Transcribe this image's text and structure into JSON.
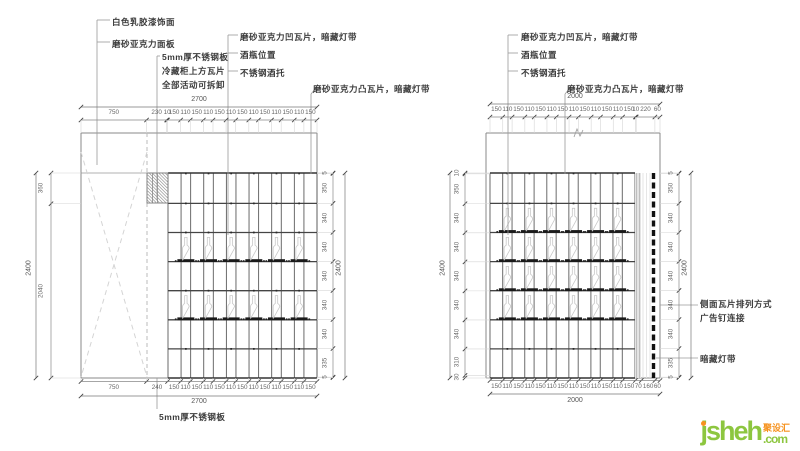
{
  "left_elevation": {
    "callouts": {
      "paint": "白色乳胶漆饰面",
      "panel": "磨砂亚克力面板",
      "steel_line1": "5mm厚不锈钢板",
      "steel_line2": "冷藏柜上方瓦片",
      "steel_line3": "全部活动可拆卸",
      "concave": "磨砂亚克力凹瓦片，暗藏灯带",
      "bottle": "酒瓶位置",
      "holder": "不锈钢酒托",
      "convex": "磨砂亚克力凸瓦片，暗藏灯带",
      "bottom_note": "5mm厚不锈钢板"
    },
    "dims": {
      "top_overall": "2700",
      "bottom_overall": "2700",
      "left_overall": "2400",
      "right_overall": "2400",
      "top": [
        "750",
        "230",
        "10",
        "150",
        "110",
        "150",
        "110",
        "150",
        "110",
        "150",
        "110",
        "150",
        "110",
        "150",
        "110",
        "150"
      ],
      "bottom": [
        "750",
        "240",
        "150",
        "110",
        "150",
        "110",
        "150",
        "110",
        "150",
        "110",
        "150",
        "110",
        "150",
        "110",
        "150"
      ],
      "left": [
        "360",
        "2040"
      ],
      "right": [
        "5",
        "350",
        "340",
        "340",
        "340",
        "340",
        "340",
        "335",
        "5"
      ]
    }
  },
  "right_elevation": {
    "callouts": {
      "concave": "磨砂亚克力凹瓦片，暗藏灯带",
      "bottle": "酒瓶位置",
      "holder": "不锈钢酒托",
      "convex": "磨砂亚克力凸瓦片，暗藏灯带",
      "side_note1": "侧面瓦片排列方式",
      "side_note2": "广告钉连接",
      "light_strip": "暗藏灯带"
    },
    "dims": {
      "top_overall": "2000",
      "bottom_overall": "2000",
      "left_overall": "2400",
      "right_overall": "2400",
      "top": [
        "150",
        "110",
        "150",
        "110",
        "150",
        "110",
        "150",
        "110",
        "150",
        "110",
        "150",
        "110",
        "150",
        "10",
        "220",
        "60"
      ],
      "bottom": [
        "150",
        "110",
        "150",
        "110",
        "150",
        "110",
        "150",
        "110",
        "150",
        "110",
        "150",
        "110",
        "150",
        "70",
        "160",
        "60"
      ],
      "left": [
        "10",
        "350",
        "340",
        "340",
        "340",
        "340",
        "340",
        "310",
        "30"
      ],
      "right": [
        "5",
        "350",
        "340",
        "340",
        "340",
        "340",
        "340",
        "335",
        "5"
      ]
    }
  },
  "logo": {
    "text": "jsheh",
    "cn": "聚设汇",
    "tld": ".com",
    "color_green": "#8dc63f",
    "color_orange": "#f6921e"
  }
}
